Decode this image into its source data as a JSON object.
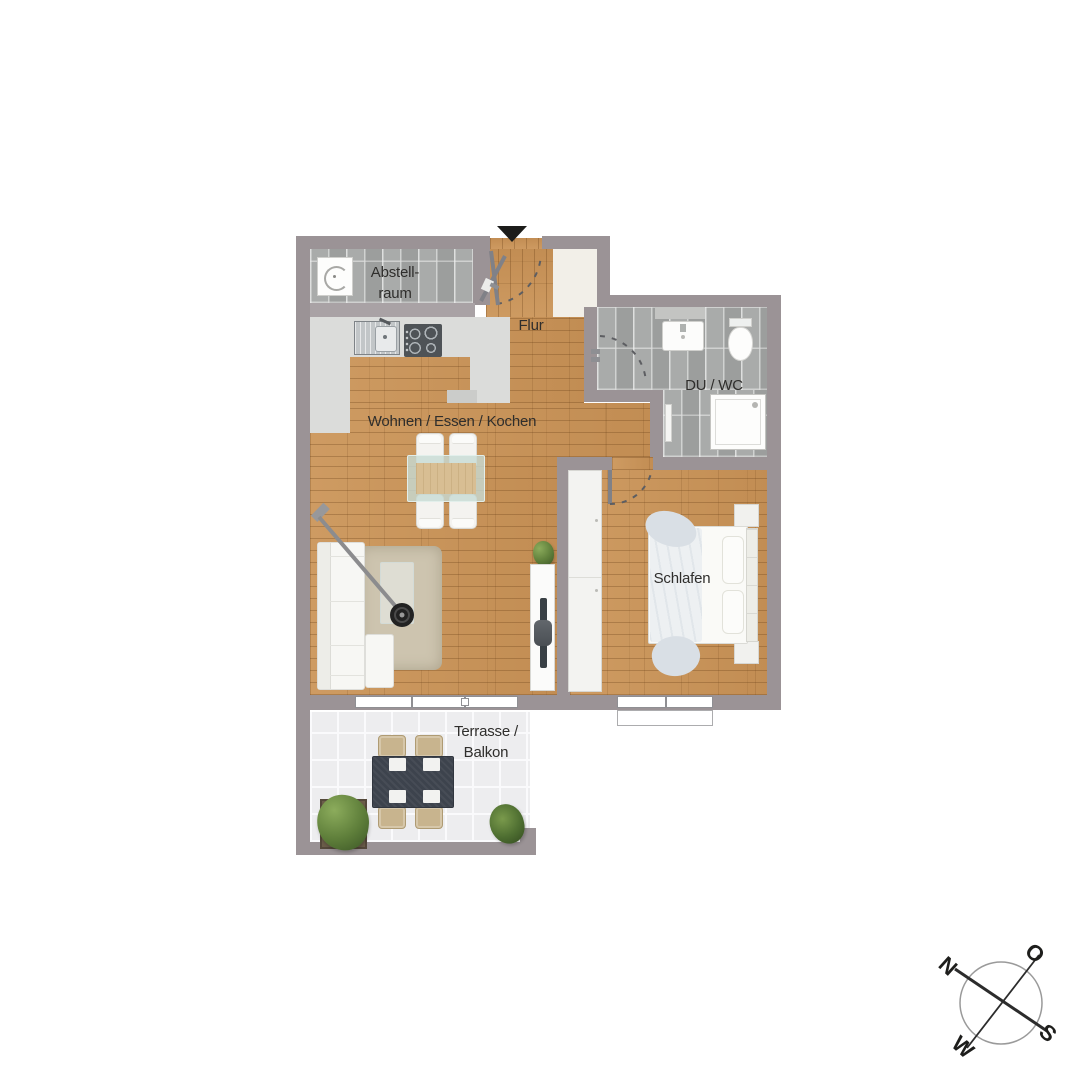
{
  "plan": {
    "rooms": {
      "abstellraum": {
        "label": [
          "Abstell-",
          "raum"
        ]
      },
      "flur": {
        "label": "Flur"
      },
      "du_wc": {
        "label": "DU / WC"
      },
      "wohnen_essen_kochen": {
        "label": "Wohnen / Essen / Kochen"
      },
      "schlafen": {
        "label": "Schlafen"
      },
      "terrasse_balkon": {
        "label": [
          "Terrasse /",
          "Balkon"
        ]
      }
    },
    "colors": {
      "wall": "#9B9396",
      "wood_floor": "#C9945C",
      "bath_tile": "#A4A6A5",
      "terrace_tile": "#EDEDEF",
      "kitchen_counter": "#DBDCDA",
      "terrace_table": "#3D434D",
      "label_text": "#2F2E2C"
    }
  },
  "compass": {
    "north": "N",
    "east": "O",
    "south": "S",
    "west": "W"
  }
}
